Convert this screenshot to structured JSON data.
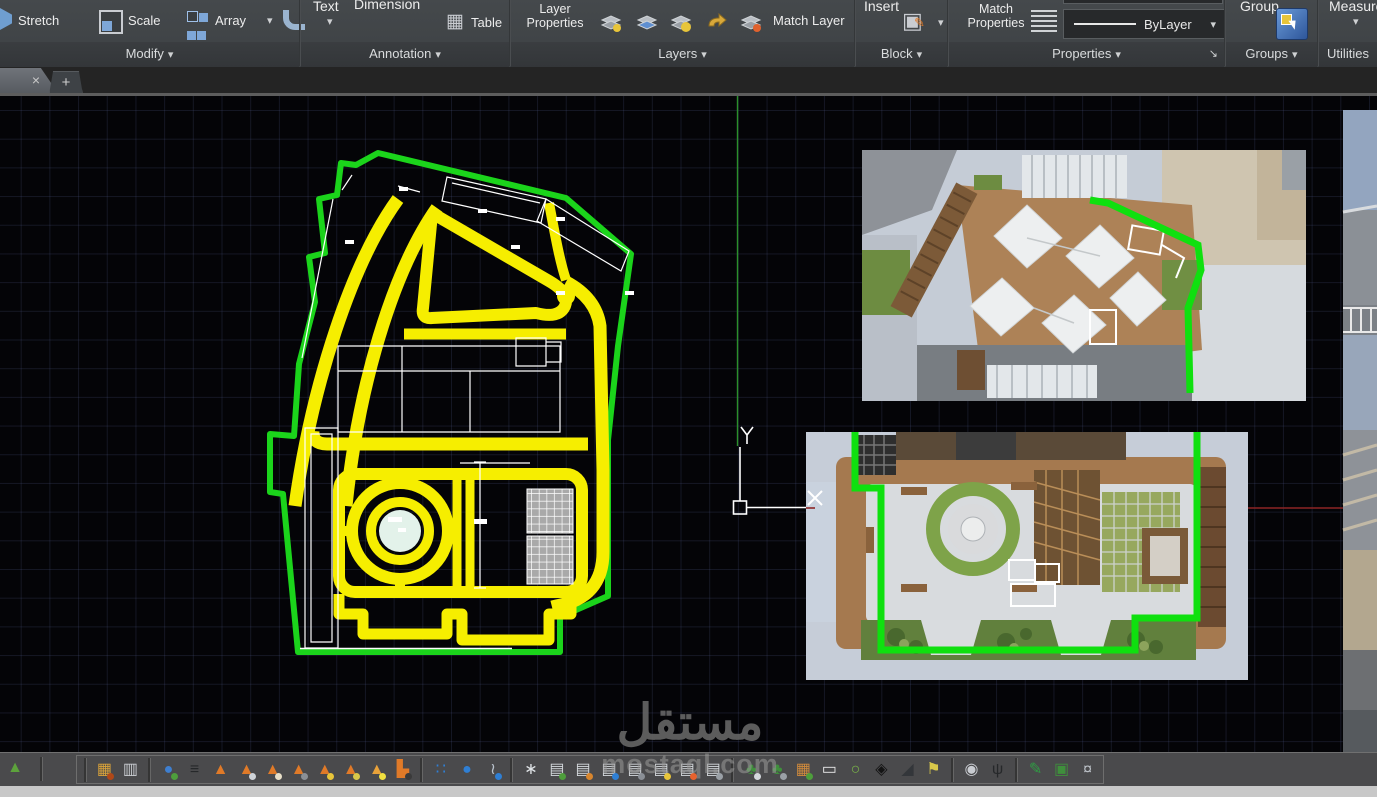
{
  "ribbon": {
    "modify": {
      "stretch": "Stretch",
      "scale": "Scale",
      "array": "Array",
      "label": "Modify"
    },
    "annotation": {
      "text": "Text",
      "dimension": "Dimension",
      "table": "Table",
      "label": "Annotation"
    },
    "layers": {
      "layer_properties": "Layer\nProperties",
      "match_layer": "Match Layer",
      "label": "Layers"
    },
    "block": {
      "insert": "Insert",
      "label": "Block"
    },
    "properties": {
      "match_properties": "Match\nProperties",
      "bylayer": "ByLayer",
      "label": "Properties"
    },
    "groups": {
      "group": "Group",
      "label": "Groups"
    },
    "utilities": {
      "measure": "Measure",
      "label": "Utilities"
    }
  },
  "tabs": {
    "close_glyph": "×",
    "new_glyph": "+"
  },
  "watermark": {
    "title": "مستقل",
    "domain": "mostaql.com"
  },
  "statusbar": {
    "icons": [
      {
        "name": "terrain-green-icon",
        "glyph": "▲",
        "color": "#5da23c"
      },
      {
        "type": "sep"
      },
      {
        "name": "materials-palette-icon",
        "glyph": "▦",
        "color": "#d8a23a",
        "accent": "#b04818"
      },
      {
        "name": "color-samples-icon",
        "glyph": "▥",
        "color": "#c9ccd1"
      },
      {
        "type": "sep"
      },
      {
        "name": "globe-icon",
        "glyph": "●",
        "color": "#3e7fd0",
        "accent": "#4e9e3c"
      },
      {
        "name": "terrain-levels-icon",
        "glyph": "≡",
        "color": "#26282a"
      },
      {
        "name": "hill-icon",
        "glyph": "▲",
        "color": "#e07a28"
      },
      {
        "name": "hill-layers-icon",
        "glyph": "▲",
        "color": "#e07a28",
        "accent": "#cfd3d8"
      },
      {
        "name": "hill-base-icon",
        "glyph": "▲",
        "color": "#e07a28",
        "accent": "#e8dfc8"
      },
      {
        "name": "hill-contour-icon",
        "glyph": "▲",
        "color": "#e07a28",
        "accent": "#8a8f96"
      },
      {
        "name": "hill-marker-icon",
        "glyph": "▲",
        "color": "#e07a28",
        "accent": "#e8c53a"
      },
      {
        "name": "hill-path-icon",
        "glyph": "▲",
        "color": "#e07a28",
        "accent": "#d8c84a"
      },
      {
        "name": "hill-flash-icon",
        "glyph": "▲",
        "color": "#e8a23a",
        "accent": "#f0e040"
      },
      {
        "name": "dump-truck-icon",
        "glyph": "▙",
        "color": "#e07a28",
        "accent": "#3a3a3a"
      },
      {
        "type": "sep"
      },
      {
        "name": "water-drops-icon",
        "glyph": "∷",
        "color": "#2f7fd4"
      },
      {
        "name": "water-drop-icon",
        "glyph": "●",
        "color": "#2f7fd4"
      },
      {
        "name": "hose-icon",
        "glyph": "≀",
        "color": "#b9c2cc",
        "accent": "#2f7fd4"
      },
      {
        "type": "sep"
      },
      {
        "name": "spray-icon",
        "glyph": "∗",
        "color": "#dfe3e6"
      },
      {
        "name": "doc-tree-icon",
        "glyph": "▤",
        "color": "#d4d8dc",
        "accent": "#4e9e3c"
      },
      {
        "name": "doc-palette-icon",
        "glyph": "▤",
        "color": "#d4d8dc",
        "accent": "#d8862e"
      },
      {
        "name": "doc-drop-icon",
        "glyph": "▤",
        "color": "#d4d8dc",
        "accent": "#2f7fd4"
      },
      {
        "name": "doc-note-icon",
        "glyph": "▤",
        "color": "#d4d8dc",
        "accent": "#8a8f96"
      },
      {
        "name": "doc-lamp-icon",
        "glyph": "▤",
        "color": "#d4d8dc",
        "accent": "#e8c53a"
      },
      {
        "name": "doc-fire-icon",
        "glyph": "▤",
        "color": "#d4d8dc",
        "accent": "#e8622e"
      },
      {
        "name": "doc-copy-icon",
        "glyph": "▤",
        "color": "#d4d8dc",
        "accent": "#9aa0a6"
      },
      {
        "type": "sep"
      },
      {
        "name": "tree-camera-icon",
        "glyph": "♣",
        "color": "#3f8f3c",
        "accent": "#d4d8dc"
      },
      {
        "name": "tree-copy-icon",
        "glyph": "♣",
        "color": "#3f8f3c",
        "accent": "#9aa0a6"
      },
      {
        "name": "photo-icon",
        "glyph": "▦",
        "color": "#cf8a3c",
        "accent": "#4e9e3c"
      },
      {
        "name": "viewport-icon",
        "glyph": "▭",
        "color": "#e8e8e8"
      },
      {
        "name": "region-tool-icon",
        "glyph": "○",
        "color": "#7ab648"
      },
      {
        "name": "north-compass-icon",
        "glyph": "◈",
        "color": "#141414"
      },
      {
        "name": "slope-tool-icon",
        "glyph": "◢",
        "color": "#33363a"
      },
      {
        "name": "sign-post-icon",
        "glyph": "⚑",
        "color": "#d8c84a"
      },
      {
        "type": "sep"
      },
      {
        "name": "camera-tripod-icon",
        "glyph": "◉",
        "color": "#c9ccd1"
      },
      {
        "name": "walk-person-icon",
        "glyph": "ψ",
        "color": "#26282a"
      },
      {
        "type": "sep"
      },
      {
        "name": "green-pencil-icon",
        "glyph": "✎",
        "color": "#2f9e44"
      },
      {
        "name": "book-globe-icon",
        "glyph": "▣",
        "color": "#3f8f3c"
      },
      {
        "name": "camera-stars-icon",
        "glyph": "¤",
        "color": "#b9bec4"
      }
    ]
  },
  "colors": {
    "accent_yellow": "#f6ee00",
    "accent_green": "#1bd41b",
    "crosshair_red": "#8b2525",
    "ribbon_bg": "#404447"
  }
}
